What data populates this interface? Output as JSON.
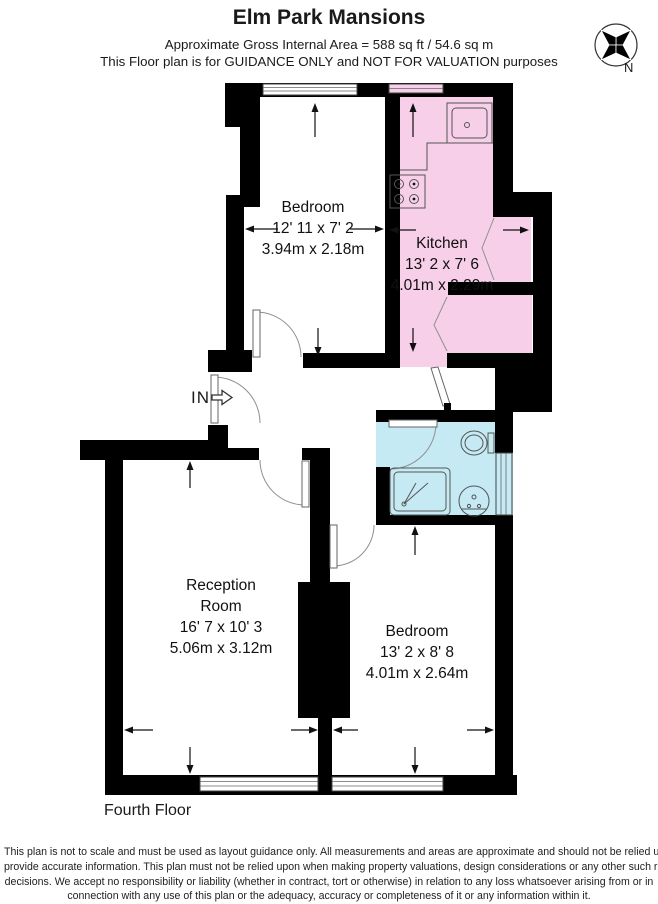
{
  "header": {
    "title": "Elm Park Mansions",
    "area_line": "Approximate Gross Internal Area = 588 sq ft / 54.6 sq m",
    "guidance_line": "This Floor plan is for GUIDANCE ONLY and NOT FOR VALUATION purposes"
  },
  "compass": {
    "north_label": "N"
  },
  "plan": {
    "floor_label": "Fourth Floor",
    "entrance_label": "IN",
    "rooms": {
      "bedroom_top": {
        "name": "Bedroom",
        "imperial": "12' 11 x 7' 2",
        "metric": "3.94m x 2.18m"
      },
      "kitchen": {
        "name": "Kitchen",
        "imperial": "13' 2 x 7' 6",
        "metric": "4.01m x 2.29m"
      },
      "reception": {
        "name_line1": "Reception",
        "name_line2": "Room",
        "imperial": "16' 7 x 10' 3",
        "metric": "5.06m x 3.12m"
      },
      "bedroom_bottom": {
        "name": "Bedroom",
        "imperial": "13' 2 x 8' 8",
        "metric": "4.01m x 2.64m"
      }
    }
  },
  "disclaimer": {
    "lines": [
      "This plan is not to scale and must be used as layout guidance only. All measurements and areas are approximate and should not be relied upon to",
      "provide accurate information. This plan must not be relied upon when making property valuations, design considerations or any other such relevant",
      "decisions. We accept no responsibility or liability (whether in contract, tort or otherwise) in relation to any loss whatsoever arising from or in",
      "connection with any use of this plan or the adequacy, accuracy or completeness of it or any information within it."
    ]
  },
  "colors": {
    "kitchen_fill": "#f8cfe9",
    "bathroom_fill": "#c5eaf4",
    "wall": "#000000"
  }
}
